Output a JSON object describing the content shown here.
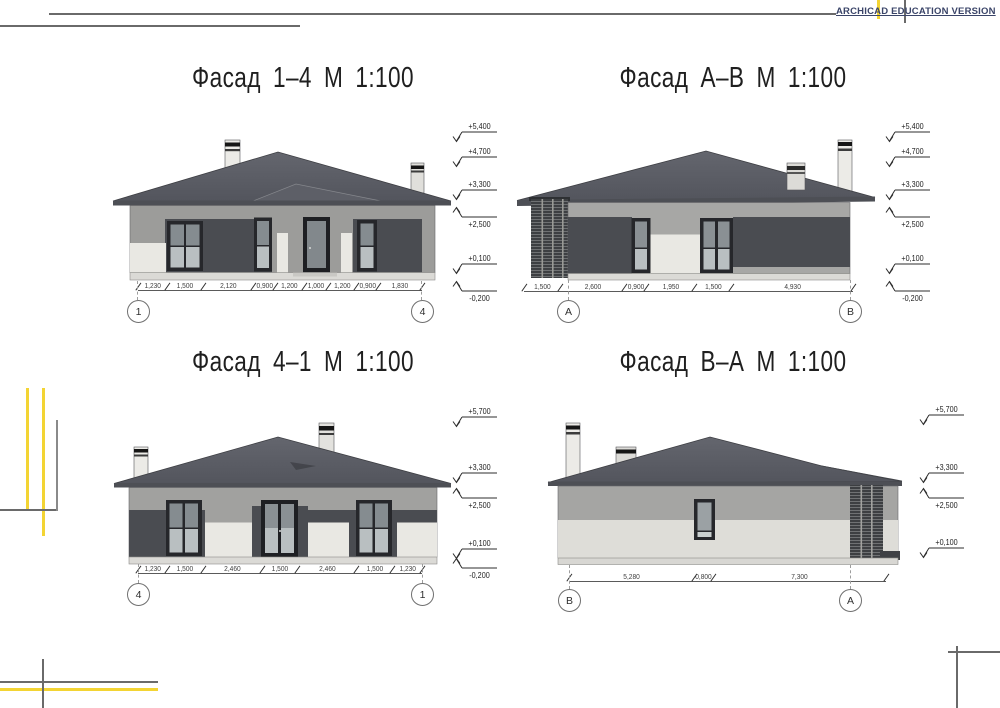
{
  "watermark": "ARCHICAD EDUCATION VERSION",
  "accent_yellow": "#f3d433",
  "line_gray": "#6a6a6a",
  "facades": [
    {
      "title": "Фасад 1–4 М 1:100",
      "axis_left": "1",
      "axis_right": "4",
      "dimensions": [
        "1,230",
        "1,500",
        "2,120",
        "0,900",
        "1,200",
        "1,000",
        "1,200",
        "0,900",
        "1,830"
      ],
      "levels": [
        {
          "label": "+5,400",
          "y": 132,
          "dir": "down"
        },
        {
          "label": "+4,700",
          "y": 157,
          "dir": "down"
        },
        {
          "label": "+3,300",
          "y": 190,
          "dir": "down"
        },
        {
          "label": "+2,500",
          "y": 217,
          "dir": "up"
        },
        {
          "label": "+0,100",
          "y": 264,
          "dir": "down"
        },
        {
          "label": "-0,200",
          "y": 291,
          "dir": "up"
        }
      ]
    },
    {
      "title": "Фасад А–В М 1:100",
      "axis_left": "А",
      "axis_right": "В",
      "dimensions": [
        "1,500",
        "2,600",
        "0,900",
        "1,950",
        "1,500",
        "4,930"
      ],
      "levels": [
        {
          "label": "+5,400",
          "y": 132,
          "dir": "down"
        },
        {
          "label": "+4,700",
          "y": 157,
          "dir": "down"
        },
        {
          "label": "+3,300",
          "y": 190,
          "dir": "down"
        },
        {
          "label": "+2,500",
          "y": 217,
          "dir": "up"
        },
        {
          "label": "+0,100",
          "y": 264,
          "dir": "down"
        },
        {
          "label": "-0,200",
          "y": 291,
          "dir": "up"
        }
      ]
    },
    {
      "title": "Фасад 4–1 М 1:100",
      "axis_left": "4",
      "axis_right": "1",
      "dimensions": [
        "1,230",
        "1,500",
        "2,460",
        "1,500",
        "2,460",
        "1,500",
        "1,230"
      ],
      "levels": [
        {
          "label": "+5,700",
          "y": 417,
          "dir": "down"
        },
        {
          "label": "+3,300",
          "y": 473,
          "dir": "down"
        },
        {
          "label": "+2,500",
          "y": 498,
          "dir": "up"
        },
        {
          "label": "+0,100",
          "y": 549,
          "dir": "down"
        },
        {
          "label": "-0,200",
          "y": 568,
          "dir": "up"
        }
      ]
    },
    {
      "title": "Фасад В–А М 1:100",
      "axis_left": "В",
      "axis_right": "А",
      "dimensions": [
        "5,280",
        "0,800",
        "7,300"
      ],
      "levels": [
        {
          "label": "+5,700",
          "y": 415,
          "dir": "down"
        },
        {
          "label": "+3,300",
          "y": 473,
          "dir": "down"
        },
        {
          "label": "+2,500",
          "y": 498,
          "dir": "up"
        },
        {
          "label": "+0,100",
          "y": 548,
          "dir": "down"
        }
      ]
    }
  ]
}
